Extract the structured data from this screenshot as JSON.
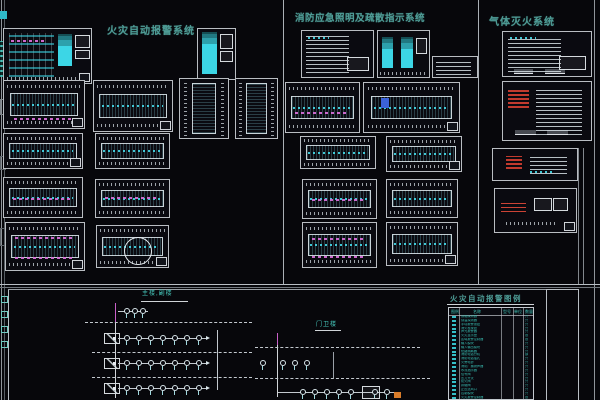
{
  "sections": {
    "fire_alarm_title": "火灾自动报警系统",
    "emergency_lighting_title": "消防应急照明及疏散指示系统",
    "gas_suppression_title": "气体灭火系统"
  },
  "bottom_band": {
    "left_schematic_label": "主楼,副楼",
    "right_schematic_label": "门卫楼",
    "bus_label_1": "AB2",
    "bus_label_2": "AB3",
    "cluster_label": "JB",
    "riser_row_labels": [
      "AL1",
      "AL2",
      "AL3"
    ],
    "branch_labels": [
      "J1",
      "J2"
    ],
    "cable_label": "WDZ-YJV",
    "legend": {
      "title": "火灾自动报警图例",
      "headers": [
        "图例",
        "名称",
        "型号",
        "单位",
        "数量"
      ],
      "rows": [
        {
          "name": "感烟探测器",
          "unit": "只"
        },
        {
          "name": "感温探测器",
          "unit": "只"
        },
        {
          "name": "手动报警按钮",
          "unit": "只"
        },
        {
          "name": "消火栓按钮",
          "unit": "只"
        },
        {
          "name": "声光报警器",
          "unit": "只"
        },
        {
          "name": "火灾显示盘",
          "unit": "台"
        },
        {
          "name": "区域报警控制器",
          "unit": "台"
        },
        {
          "name": "输入模块",
          "unit": "只"
        },
        {
          "name": "输入输出模块",
          "unit": "只"
        },
        {
          "name": "短路隔离器",
          "unit": "只"
        },
        {
          "name": "消防电话分机",
          "unit": "部"
        },
        {
          "name": "消防电话插孔",
          "unit": "只"
        },
        {
          "name": "火警电铃",
          "unit": "只"
        },
        {
          "name": "消防广播扬声器",
          "unit": "只"
        },
        {
          "name": "水流指示器",
          "unit": "只"
        },
        {
          "name": "信号阀",
          "unit": "只"
        },
        {
          "name": "压力开关",
          "unit": "只"
        },
        {
          "name": "防火阀",
          "unit": "只"
        },
        {
          "name": "排烟阀",
          "unit": "只"
        },
        {
          "name": "正压送风口",
          "unit": "只"
        },
        {
          "name": "控制模块",
          "unit": "只"
        },
        {
          "name": "火灾报警控制器",
          "unit": "台"
        }
      ]
    }
  },
  "colors": {
    "background": "#07070b",
    "frame_line": "#b9bdc2",
    "title_teal": "#4e9c96",
    "drawing_cyan": "#3cd6e6",
    "annotation_magenta": "#c75fc7",
    "alert_red": "#c23a2e",
    "accent_orange": "#d97c2a",
    "legend_text": "#38bdb2"
  }
}
